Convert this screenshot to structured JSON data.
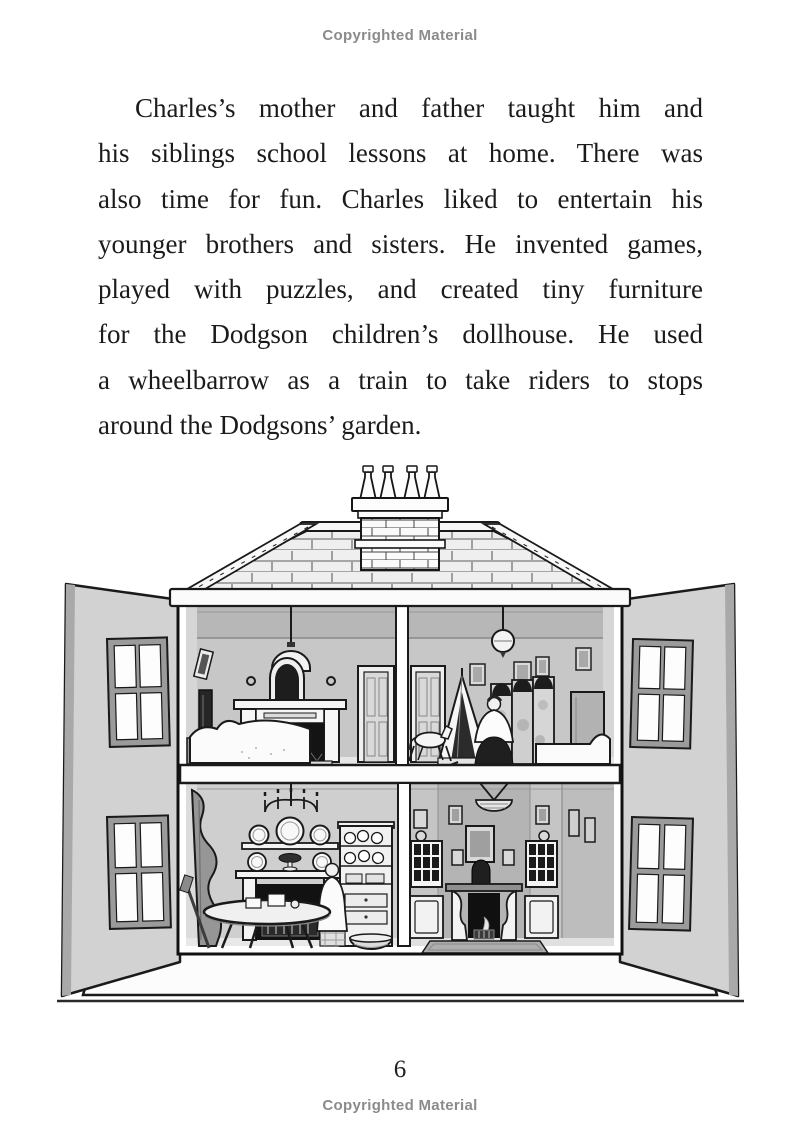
{
  "page": {
    "top_notice": "Copyrighted Material",
    "bottom_notice": "Copyrighted Material",
    "page_number": "6"
  },
  "paragraph": {
    "lines": [
      "Charles’s mother and father taught him and",
      "his siblings school lessons at home. There was",
      "also time for fun. Charles liked to entertain his",
      "younger brothers and sisters. He invented games,",
      "played with puzzles, and created tiny furniture",
      "for the Dodgson children’s dollhouse. He used",
      "a wheelbarrow as a train to take riders to stops",
      "around the Dodgsons’ garden."
    ],
    "full_text": "Charles’s mother and father taught him and his siblings school lessons at home. There was also time for fun. Charles liked to entertain his younger brothers and sisters. He invented games, played with puzzles, and created tiny furniture for the Dodgson children’s dollhouse. He used a wheelbarrow as a train to take riders to stops around the Dodgsons’ garden."
  },
  "illustration": {
    "type": "black-and-white line drawing",
    "subject": "Victorian dollhouse with its two front doors swung open showing four furnished rooms",
    "rooms": [
      "upper-left bedroom with bed, fireplace and arched mirror",
      "upper-right nursery with rocking horse, draped crib, nanny figure, folding screen and bed",
      "lower-left kitchen with chandelier, plate shelves, round table, cook figure, dresser and basket",
      "lower-right parlor with chandelier, fireplace, paned windows and rug"
    ],
    "features": [
      "hipped tiled roof",
      "brick chimney with four pots",
      "hinged front doors with four-pane windows",
      "white plinth base"
    ]
  },
  "colors": {
    "background": "#ffffff",
    "body_text": "#1b1b1b",
    "notice_text": "#8b8b8b",
    "line_art": "#1a1a1a",
    "wall_gray": "#c7c7c7",
    "door_gray": "#d2d2d2"
  }
}
